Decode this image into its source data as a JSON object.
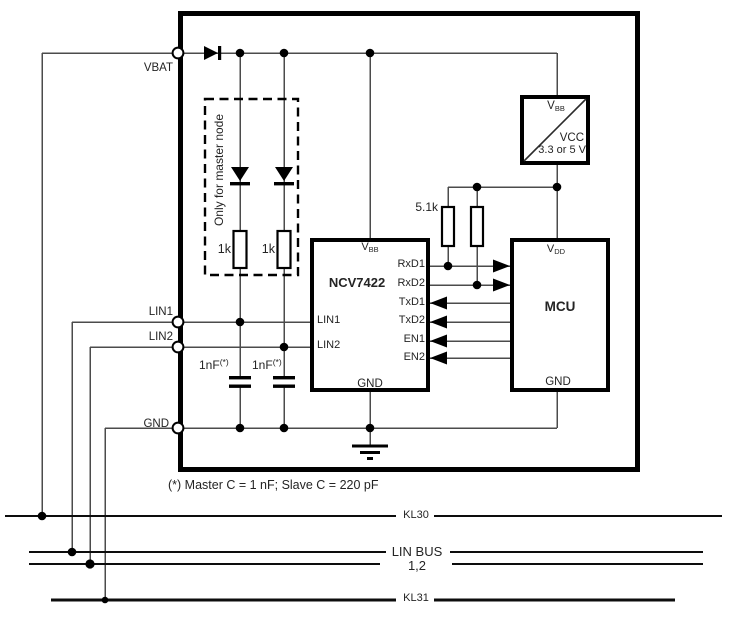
{
  "schematic": {
    "terminals": {
      "vbat": "VBAT",
      "lin1": "LIN1",
      "lin2": "LIN2",
      "gnd": "GND"
    },
    "master_section": {
      "label": "Only for master node",
      "r1": "1k",
      "r2": "1k"
    },
    "caps": {
      "c1": "1nF",
      "c2": "1nF",
      "sup": "(*)"
    },
    "pullup": {
      "value": "5.1k"
    },
    "transceiver": {
      "name": "NCV7422",
      "vbb_main": "V",
      "vbb_sub": "BB",
      "pins_right": [
        "RxD1",
        "RxD2",
        "TxD1",
        "TxD2",
        "EN1",
        "EN2"
      ],
      "pin_lin1": "LIN1",
      "pin_lin2": "LIN2",
      "pin_gnd": "GND"
    },
    "regulator": {
      "in_main": "V",
      "in_sub": "BB",
      "out": "VCC",
      "rating": "3.3 or 5 V"
    },
    "mcu": {
      "name": "MCU",
      "vdd_main": "V",
      "vdd_sub": "DD",
      "pin_gnd": "GND"
    },
    "note": "(*) Master C = 1 nF; Slave C = 220 pF",
    "bus": {
      "kl30": "KL30",
      "lin_name": "LIN BUS",
      "lin_num": "1,2",
      "kl31": "KL31"
    },
    "colors": {
      "wire": "#4b4b4b",
      "ink": "#000000"
    }
  }
}
